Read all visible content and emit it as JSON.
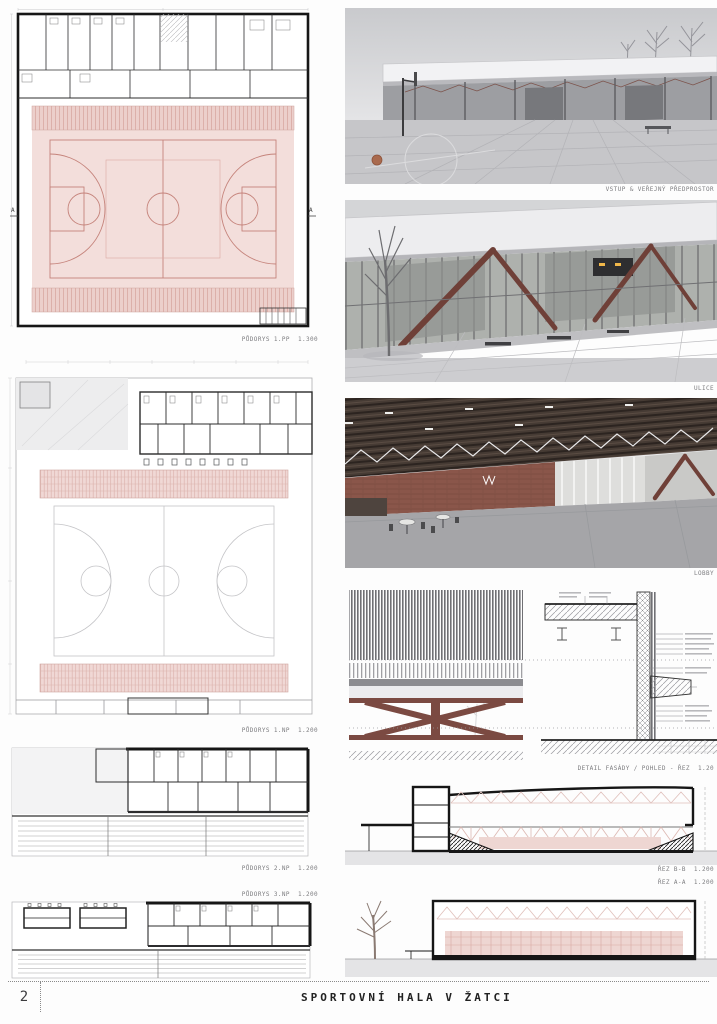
{
  "board": {
    "page_number": "2",
    "title": "SPORTOVNÍ HALA V ŽATCI"
  },
  "plans": {
    "p1": {
      "caption": "PŮDORYS 1.PP  1.300",
      "marker_left": "A",
      "marker_right": "A"
    },
    "p2": {
      "caption": "PŮDORYS 1.NP  1.200"
    },
    "p3": {
      "caption": "PŮDORYS 2.NP  1.200"
    },
    "p4": {
      "caption": "PŮDORYS 3.NP  1.200"
    }
  },
  "renders": {
    "entry": {
      "caption": "VSTUP & VEŘEJNÝ PŘEDPROSTOR"
    },
    "street": {
      "caption": "ULICE"
    },
    "lobby": {
      "caption": "LOBBY"
    }
  },
  "details": {
    "facade": {
      "caption": "DETAIL FASÁDY / POHLED - ŘEZ  1.20"
    }
  },
  "sections": {
    "bb": {
      "caption": "ŘEZ B-B  1.200"
    },
    "aa": {
      "caption": "ŘEZ A-A  1.200"
    }
  },
  "colors": {
    "court_pink": "#f3dedb",
    "tribune_pink": "#edd2ce",
    "marking_red": "#c5837b",
    "brace_maroon": "#6f4038",
    "ink": "#161616"
  }
}
